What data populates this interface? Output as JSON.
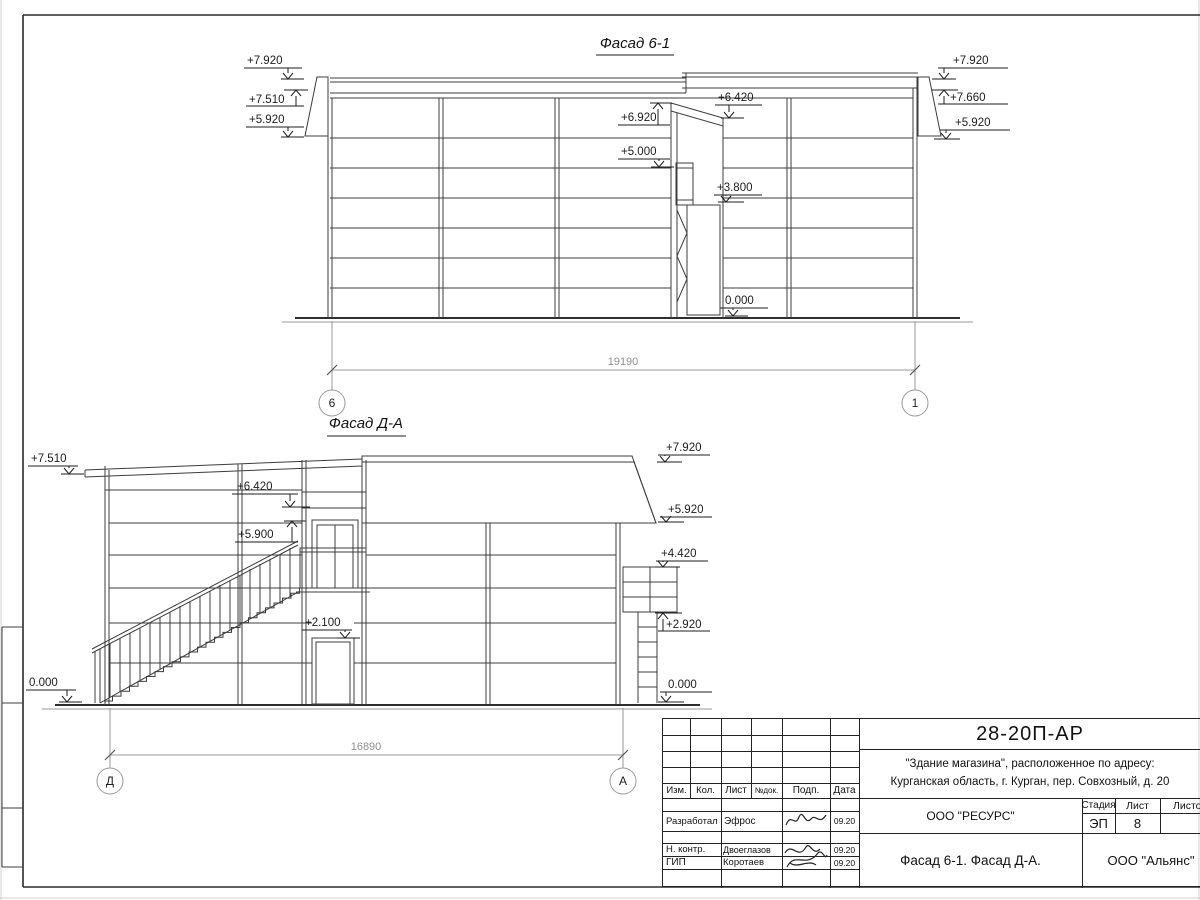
{
  "facade1": {
    "title": "Фасад 6-1",
    "marks": {
      "left1": "+7.920",
      "left2": "+7.510",
      "left3": "+5.920",
      "mid1": "+6.920",
      "mid2": "+6.420",
      "mid3": "+5.000",
      "mid4": "+3.800",
      "mid5": "0.000",
      "right1": "+7.920",
      "right2": "+7.660",
      "right3": "+5.920"
    },
    "dimension": "19190",
    "axis_left": "6",
    "axis_right": "1"
  },
  "facade2": {
    "title": "Фасад Д-А",
    "marks": {
      "left1": "+7.510",
      "left2": "0.000",
      "mid1": "+6.420",
      "mid2": "+5.900",
      "mid3": "+2.100",
      "right1": "+7.920",
      "right2": "+5.920",
      "right3": "+4.420",
      "right4": "+2.920",
      "right5": "0.000"
    },
    "dimension": "16890",
    "axis_left": "Д",
    "axis_right": "А"
  },
  "titleblock": {
    "code": "28-20П-АР",
    "object_line1": "\"Здание магазина\", расположенное по адресу:",
    "object_line2": "Курганская область, г. Курган, пер. Совхозный, д. 20",
    "headers": {
      "izm": "Изм.",
      "kol": "Кол.",
      "list": "Лист",
      "ndok": "№док.",
      "podp": "Подп.",
      "data": "Дата"
    },
    "rows": [
      {
        "role": "Разработал",
        "name": "Эфрос",
        "date": "09.20"
      },
      {
        "role": "Н. контр.",
        "name": "Двоеглазов",
        "date": "09.20"
      },
      {
        "role": "ГИП",
        "name": "Коротаев",
        "date": "09.20"
      }
    ],
    "org": "ООО \"РЕСУРС\"",
    "stage_label": "Стадия",
    "sheet_label": "Лист",
    "sheets_label": "Листов",
    "stage": "ЭП",
    "sheet_number": "8",
    "sheet_title": "Фасад 6-1. Фасад Д-А.",
    "company": "ООО \"Альянс\""
  }
}
